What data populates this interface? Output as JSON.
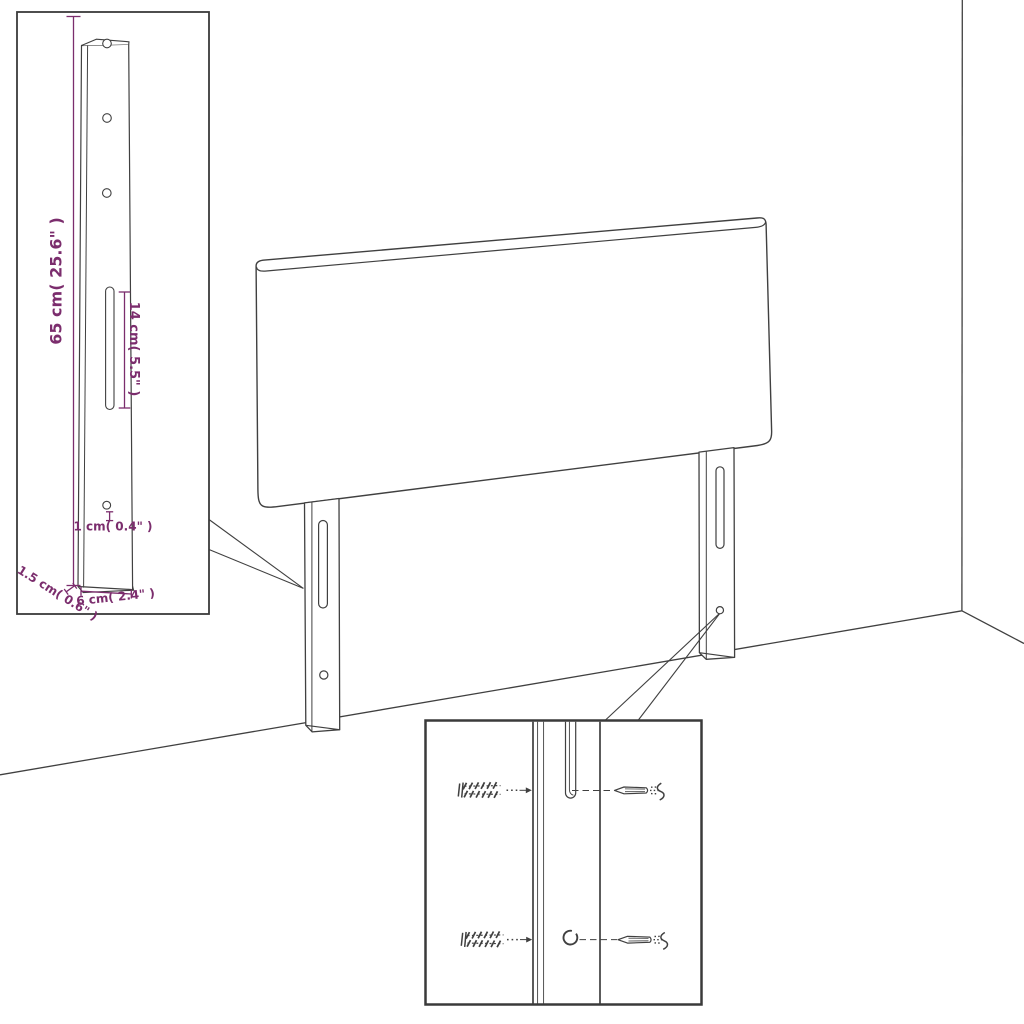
{
  "figure": {
    "kind": "headboard-assembly-dimension-diagram",
    "background": "#ffffff",
    "line_color": "#404040",
    "dimension_color": "#7b2d6d"
  },
  "leg_detail_inset": {
    "dimensions": {
      "height": "65 cm( 25.6\" )",
      "slot_length": "14 cm( 5.5\" )",
      "hole": "1 cm( 0.4\" )",
      "thickness": "1.5 cm( 0.6\" )",
      "width": "6 cm( 2.4\" )"
    }
  },
  "hardware_inset": {
    "rows": [
      {
        "left_icon": "wall-plug-icon",
        "target": "slot",
        "right_icon": "screw-icon"
      },
      {
        "left_icon": "wall-plug-icon",
        "target": "round-hole",
        "right_icon": "screw-icon"
      }
    ]
  }
}
